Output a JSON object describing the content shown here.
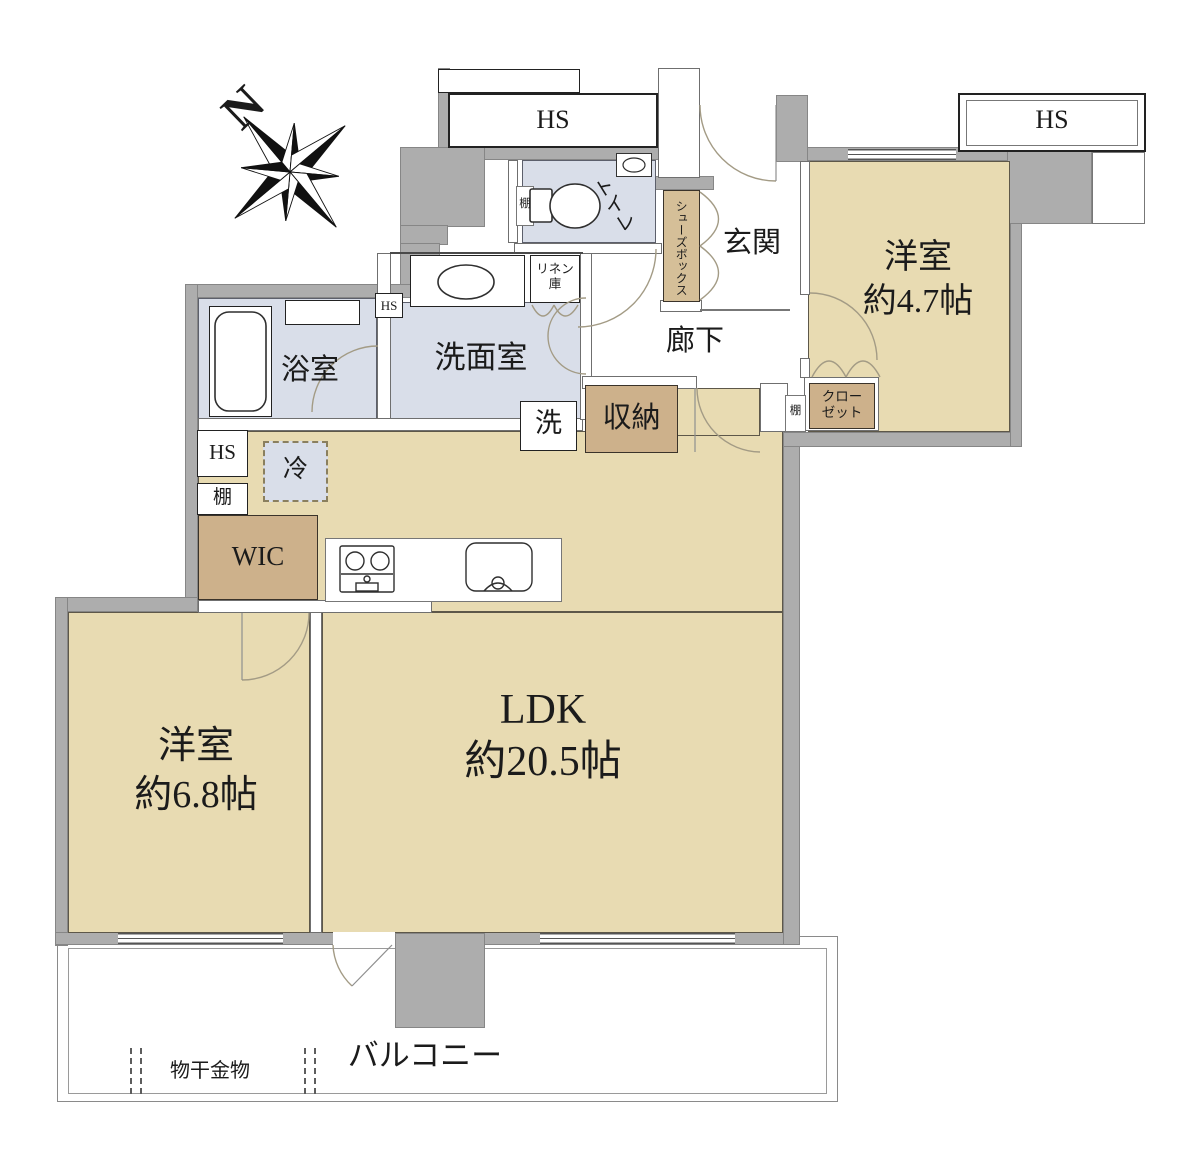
{
  "compass": {
    "north": "N"
  },
  "rooms": {
    "ldk": {
      "name": "LDK",
      "area": "約20.5帖"
    },
    "bedroom_68": {
      "name": "洋室",
      "area": "約6.8帖"
    },
    "bedroom_47": {
      "name": "洋室",
      "area": "約4.7帖"
    },
    "bathroom": {
      "label": "浴室"
    },
    "washroom": {
      "label": "洗面室"
    },
    "toilet": {
      "label": "トイレ"
    },
    "entrance": {
      "label": "玄関"
    },
    "hallway": {
      "label": "廊下"
    },
    "balcony": {
      "label": "バルコニー"
    }
  },
  "storage": {
    "wic": "WIC",
    "storage_closet": "収納",
    "closet": [
      "クロー",
      "ゼット"
    ],
    "shoe_box": "シューズボックス",
    "linen": [
      "リネン",
      "庫"
    ],
    "shelf": "棚"
  },
  "fixtures": {
    "refrigerator": "冷",
    "washing_machine": "洗",
    "hs": "HS",
    "drying_hardware": "物干金物"
  },
  "colors": {
    "room_tan": "#e8dbb2",
    "wet_blue": "#d9dee9",
    "storage_brown": "#cdb18b",
    "wall_gray": "#adadad"
  }
}
